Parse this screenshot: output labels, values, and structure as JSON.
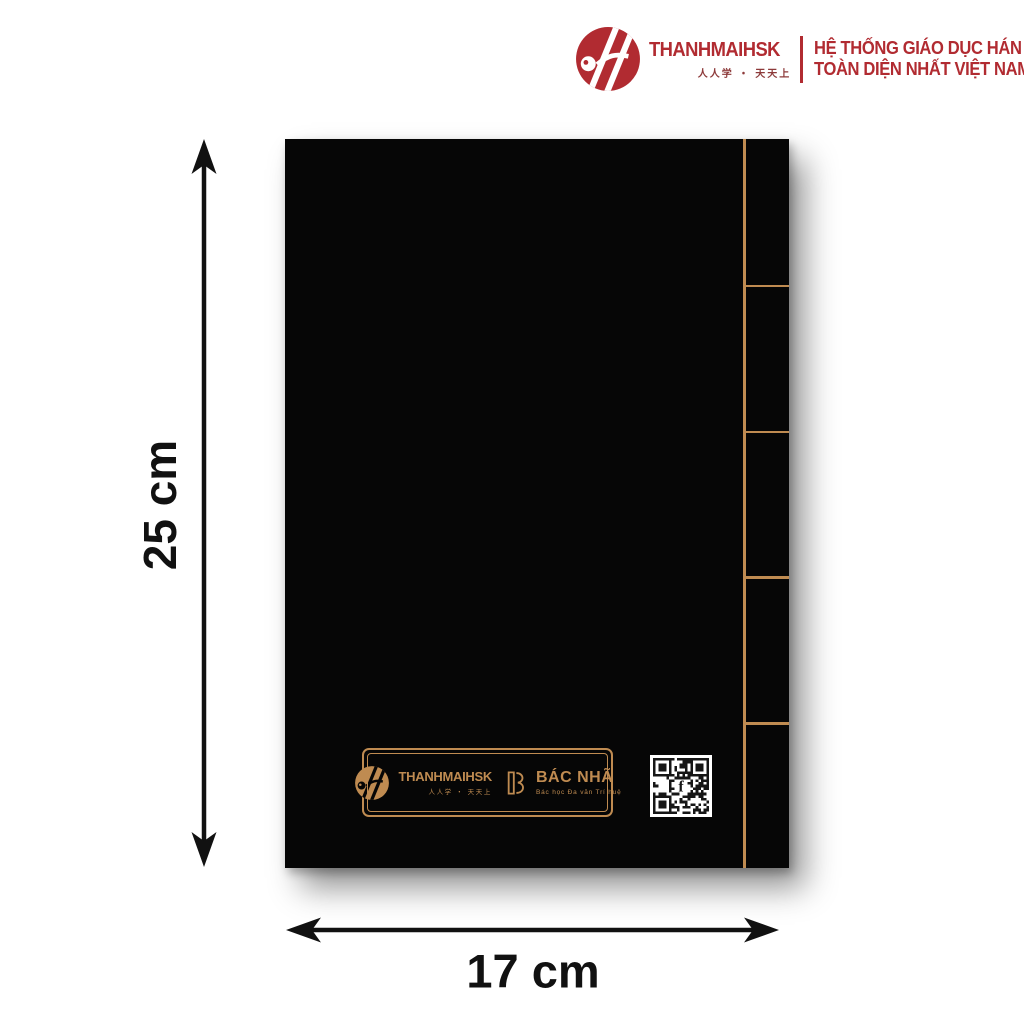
{
  "header": {
    "brand": "THANHMAIHSK",
    "brand_sub": "人人学 ・ 天天上",
    "slogan_line1": "HỆ THỐNG GIÁO DỤC HÁN NGỮ",
    "slogan_line2": "TOÀN DIỆN NHẤT VIỆT NAM"
  },
  "cover": {
    "tabs": 5,
    "plate": {
      "brand": "THANHMAIHSK",
      "brand_sub": "人人学 ・ 天天上",
      "partner_name": "BÁC NHÃ",
      "partner_tagline": "Bác học Đa văn Trí huệ"
    },
    "qr_label": "facebook-qr-code"
  },
  "dimensions": {
    "height": "25 cm",
    "width": "17 cm"
  },
  "colors": {
    "brand_red": "#B12B31",
    "gold": "#BF8B51",
    "cover_black": "#060606"
  }
}
